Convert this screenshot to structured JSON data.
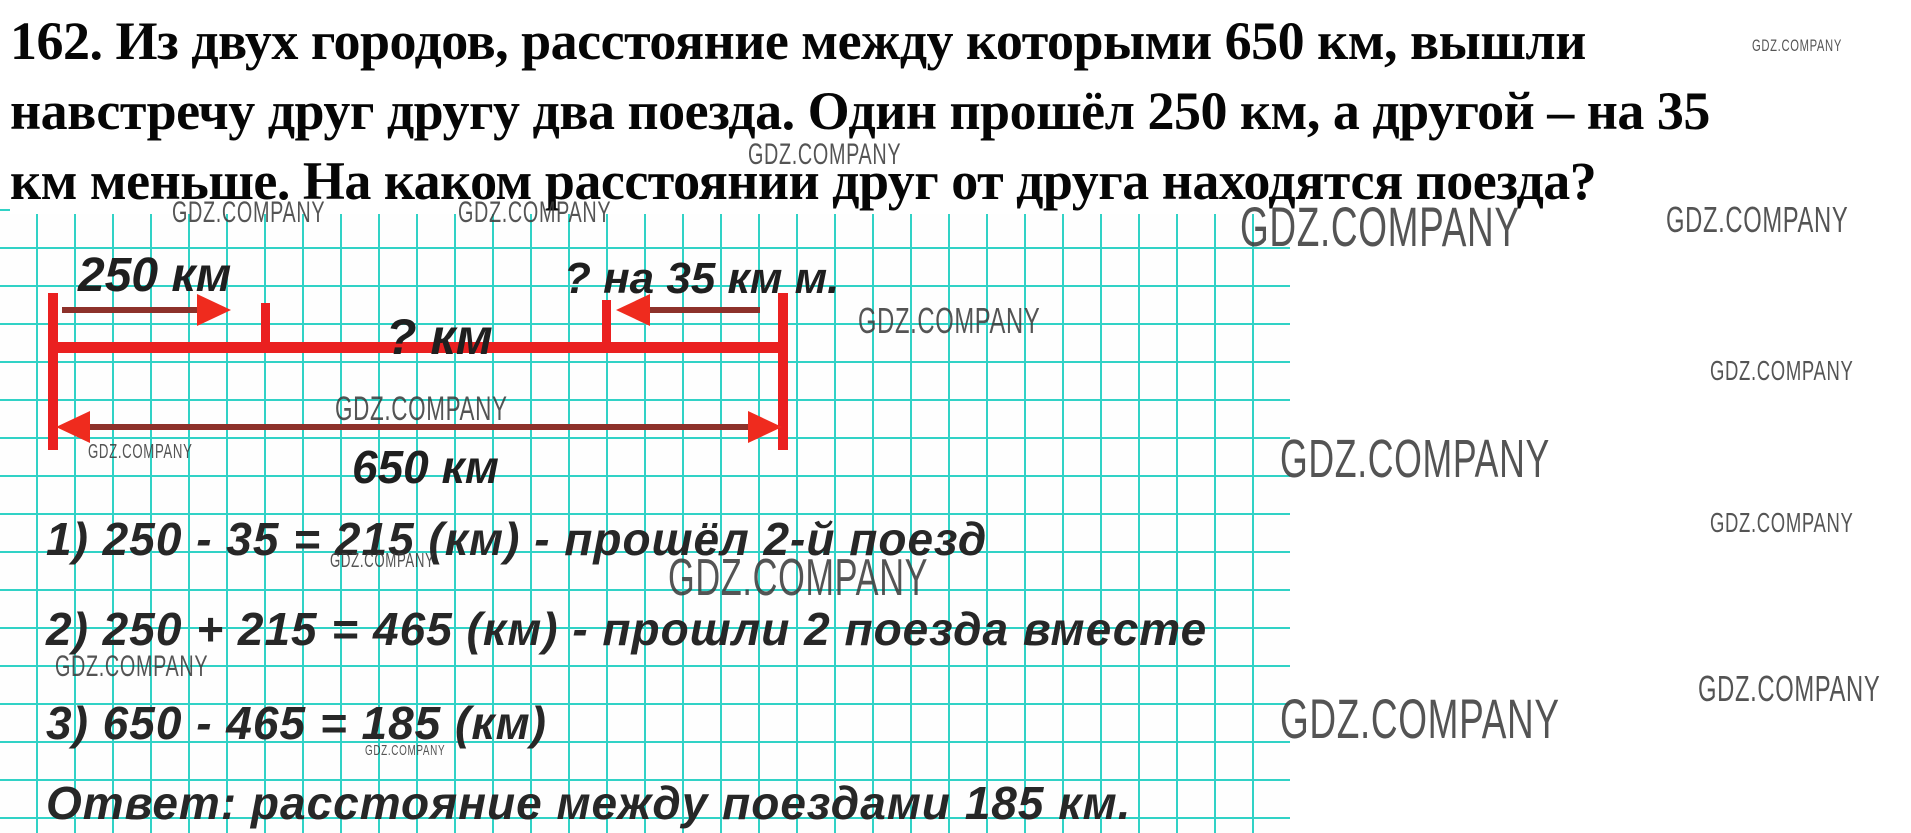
{
  "problem": {
    "lines": [
      "162. Из двух городов, расстояние между которыми 650 км, вышли",
      "навстречу друг другу два поезда. Один прошёл 250 км, а другой – на 35",
      "км меньше. На каком расстоянии друг от друга находятся поезда?"
    ]
  },
  "diagram": {
    "label_first_train": "250 км",
    "label_second_train": "? на 35 км м.",
    "label_gap": "? км",
    "label_total": "650 км"
  },
  "solution": {
    "steps": [
      "1) 250 - 35 = 215 (км) - прошёл 2-й поезд",
      "2) 250 + 215 = 465 (км) - прошли 2 поезда вместе",
      "3) 650 - 465 = 185 (км)"
    ],
    "answer": "Ответ: расстояние между поездами 185 км."
  },
  "watermark": {
    "text": "GDZ.COMPANY",
    "instances": [
      {
        "x": 172,
        "y": 196,
        "size": 30
      },
      {
        "x": 458,
        "y": 196,
        "size": 30
      },
      {
        "x": 748,
        "y": 138,
        "size": 30
      },
      {
        "x": 335,
        "y": 390,
        "size": 34
      },
      {
        "x": 858,
        "y": 300,
        "size": 36
      },
      {
        "x": 88,
        "y": 441,
        "size": 20
      },
      {
        "x": 330,
        "y": 550,
        "size": 20
      },
      {
        "x": 668,
        "y": 548,
        "size": 52
      },
      {
        "x": 55,
        "y": 650,
        "size": 30
      },
      {
        "x": 365,
        "y": 742,
        "size": 15
      },
      {
        "x": 1752,
        "y": 36,
        "size": 17
      },
      {
        "x": 1240,
        "y": 194,
        "size": 56
      },
      {
        "x": 1666,
        "y": 199,
        "size": 36
      },
      {
        "x": 1710,
        "y": 355,
        "size": 28
      },
      {
        "x": 1280,
        "y": 428,
        "size": 54
      },
      {
        "x": 1710,
        "y": 507,
        "size": 28
      },
      {
        "x": 1280,
        "y": 686,
        "size": 56
      },
      {
        "x": 1698,
        "y": 668,
        "size": 36
      }
    ]
  },
  "colors": {
    "grid": "#31d2c6",
    "line_red": "#ea2020",
    "shaft_red": "#8d312a",
    "head_red": "#ef2b1e",
    "watermark": "#3d3d3d"
  }
}
